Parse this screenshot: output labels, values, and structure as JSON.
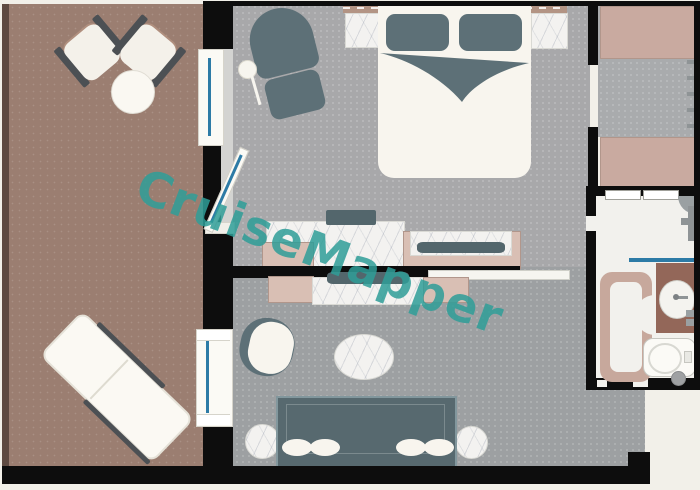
{
  "watermark": {
    "text": "CruiseMapper"
  },
  "palette": {
    "page_bg": "#f2f0e9",
    "wall": "#0d0d0d",
    "balcony": "#9b7e71",
    "balcony_edge": "#5e4a41",
    "bedroom_floor": "#a8a8aa",
    "living_floor": "#9da0a2",
    "entry_floor": "#a9abad",
    "closet": "#c9aaa0",
    "cabinet": "#d9bfb4",
    "cabinet_border": "#b1968b",
    "slate": "#5d7077",
    "slate_dark": "#53666c",
    "sofa": "#57696f",
    "bed_cream": "#f8f5ee",
    "marble": "#f3f2f0",
    "headboard_tan": "#b39484",
    "vanity_brown": "#936759",
    "shower_beige": "#c7a89c",
    "glass_blue": "#2d7ba6",
    "bath_floor": "#f2f1ed",
    "track_gray": "#d3d3d1",
    "fixture_gray": "#8f9496",
    "watermark_color": "#2f9e98"
  }
}
